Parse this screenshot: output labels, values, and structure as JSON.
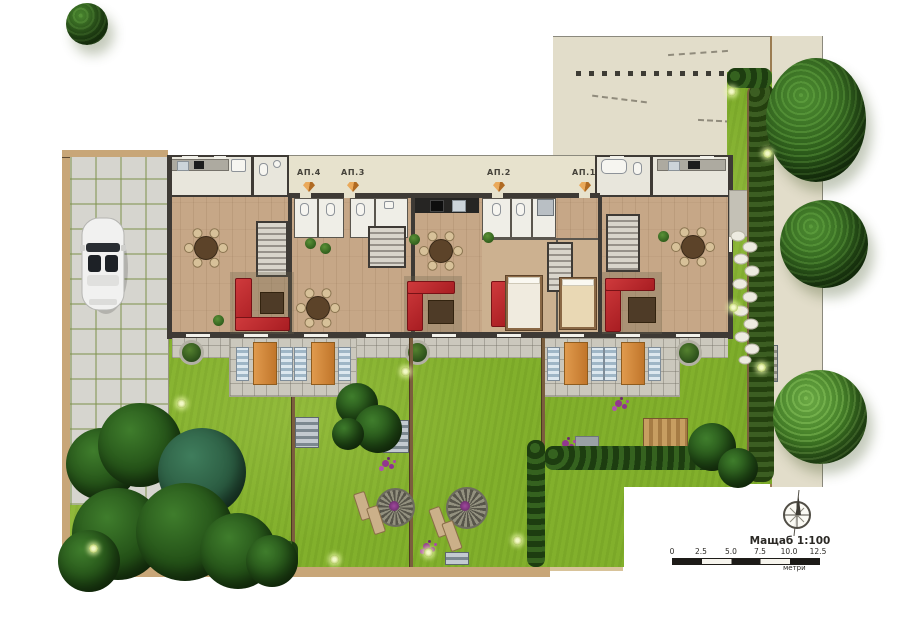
{
  "apartments": [
    {
      "label": "АП.4"
    },
    {
      "label": "АП.3"
    },
    {
      "label": "АП.2"
    },
    {
      "label": "АП.1"
    }
  ],
  "scale": {
    "title": "Мащаб 1:100",
    "ticks": [
      "0",
      "2.5",
      "5.0",
      "7.5",
      "10.0",
      "12.5"
    ],
    "unit": "метри"
  },
  "icons": {
    "north_arrow": "compass-north-arrow",
    "entrance_marker": "orange-diamond-entrance-arrow",
    "car": "white-convertible-car-top-view",
    "garden_light": "round-garden-light",
    "sun_loungers": "pool-lounger-trio"
  },
  "colors": {
    "lawn": "#82b02c",
    "hedge_dark": "#1d3d10",
    "tree_green": "#2e5e1c",
    "sofa_red": "#c1262b",
    "terrace_tile": "#cbc8bd",
    "neighbor_beige": "#e2ddca",
    "walkway_beige": "#e7e2cd",
    "wall_dark": "#3e3a35",
    "wood_floor": "#c6a787",
    "plot_border_tan": "#c8a678",
    "entrance_orange": "#d98c3a",
    "lounger_orange": "#d08a3e",
    "garden_steps": "#8fa0aa",
    "parking_tile": "#d6d5cf"
  }
}
